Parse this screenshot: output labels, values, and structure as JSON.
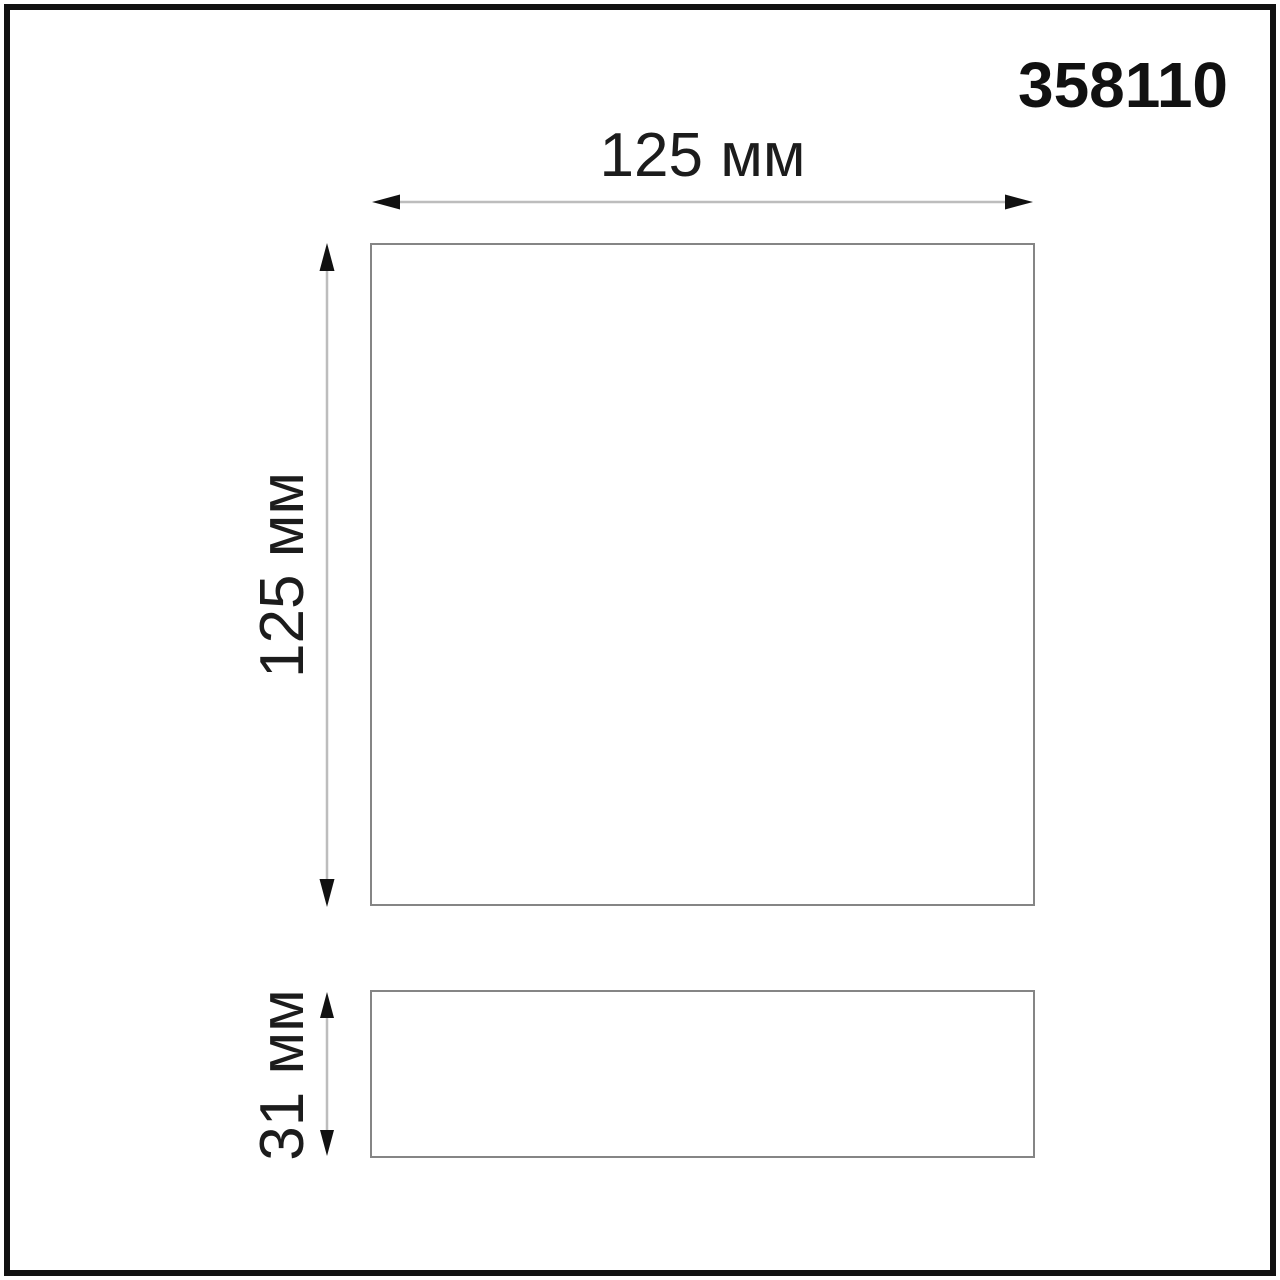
{
  "title": "358110",
  "dimensions": {
    "width": {
      "label": "125 мм"
    },
    "height": {
      "label": "125 мм"
    },
    "depth": {
      "label": "31 мм"
    }
  },
  "colors": {
    "frame_border": "#111111",
    "outline": "#858585",
    "dimension_line": "#bdbdbd",
    "arrowhead": "#111111",
    "text": "#1c1c1c",
    "background": "#ffffff"
  }
}
